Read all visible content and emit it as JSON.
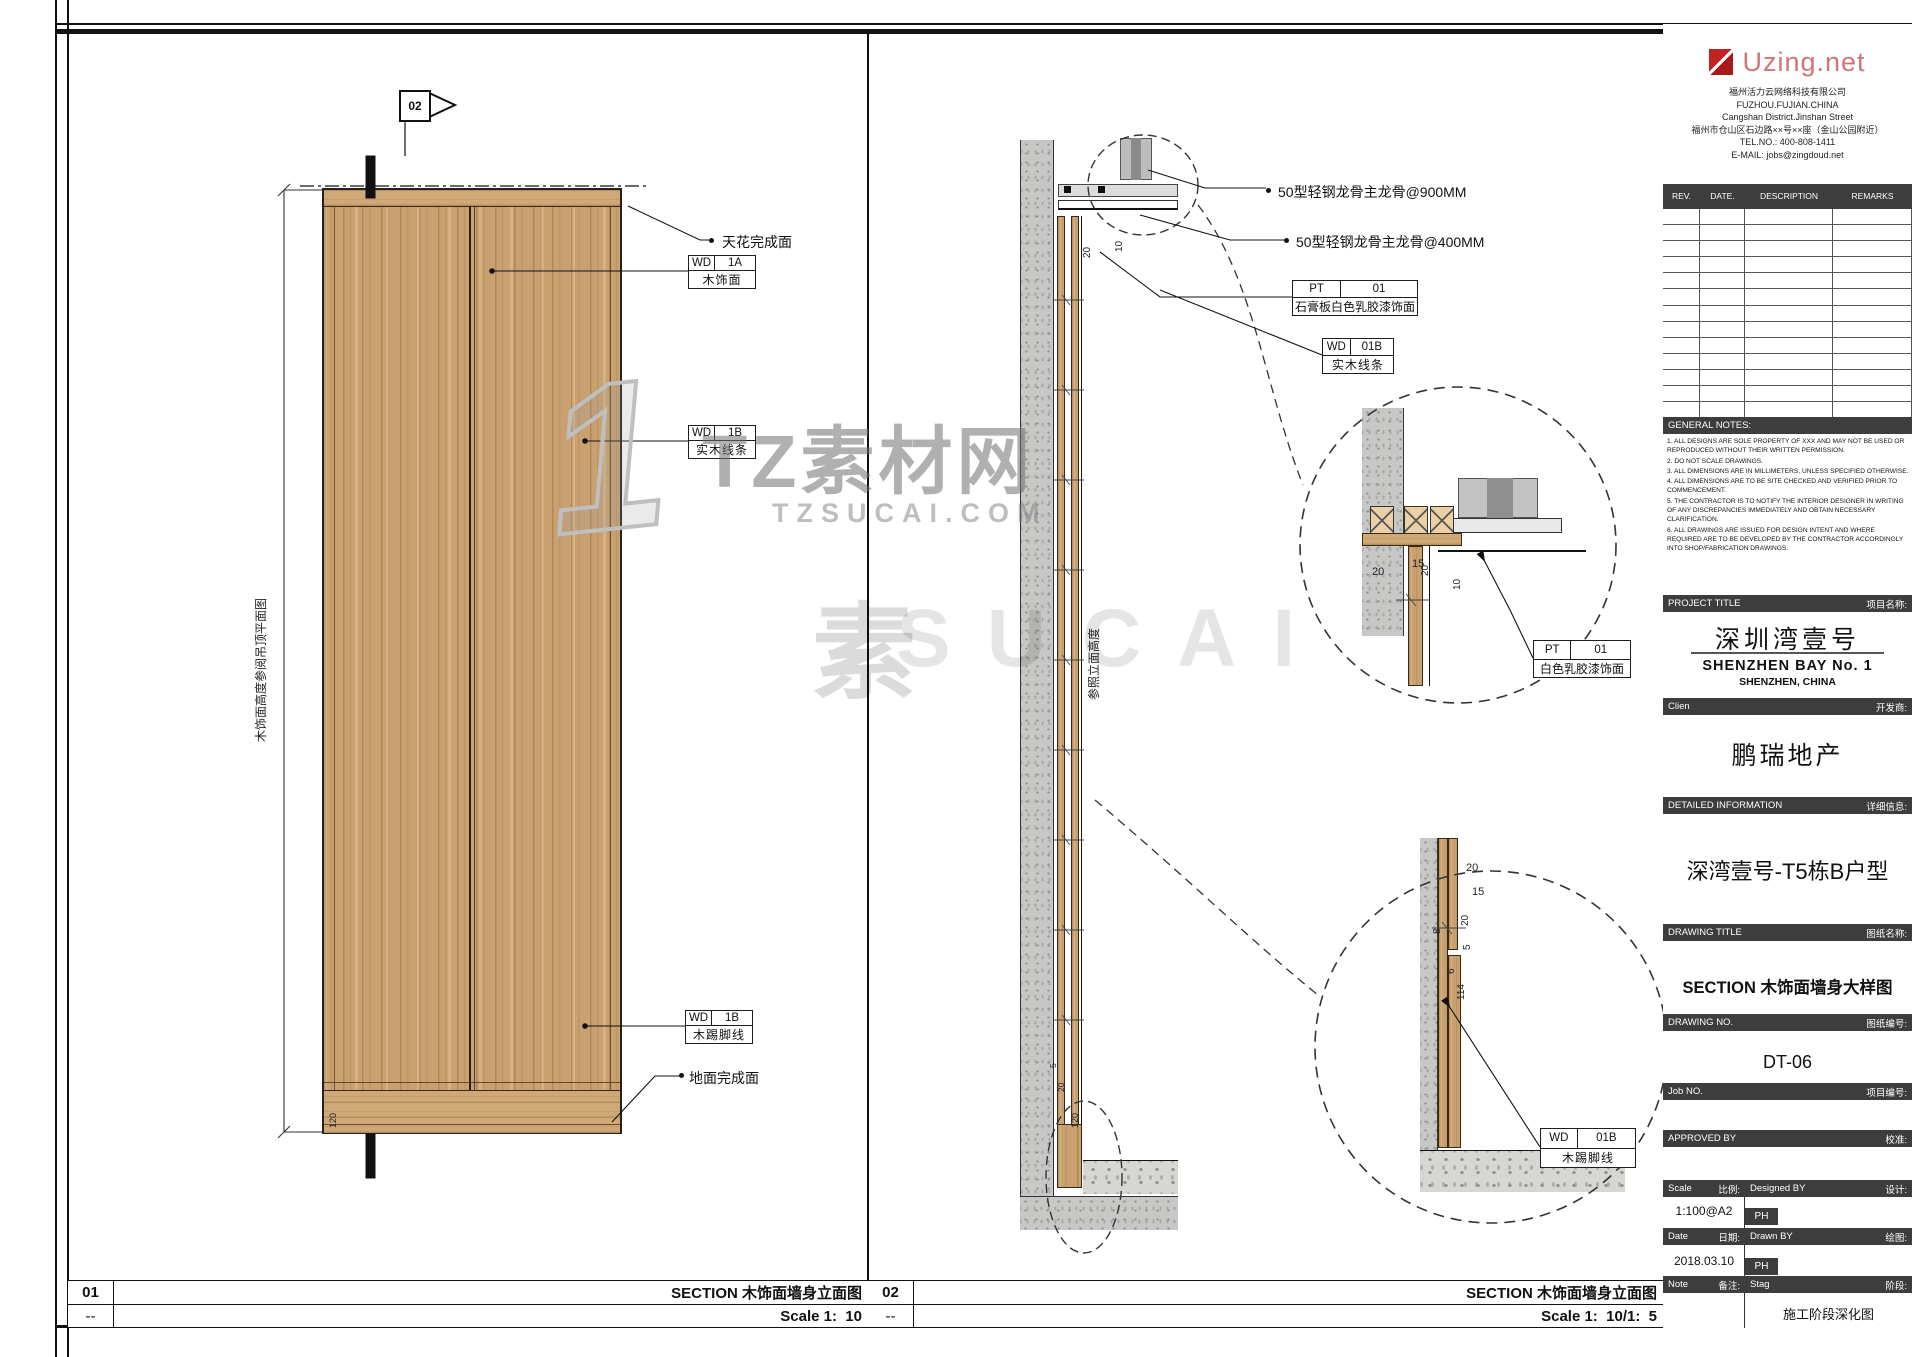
{
  "colors": {
    "accent_red": "#c32222",
    "logo_pink": "#d07575",
    "bar_dark": "#3d3d3d",
    "wood": "#c9a171",
    "concrete_gray": "#c7c7c5"
  },
  "watermark": {
    "big_one": "1",
    "brand": "TZ素材网",
    "domain": "TZSUCAI.COM",
    "faint_char": "素",
    "faint_letters": "SUCAI"
  },
  "panel1": {
    "number": "01",
    "rev": "--",
    "title": "SECTION 木饰面墙身立面图",
    "scale": "Scale 1:  10",
    "section_flag": "02",
    "height_note": "木饰面高度参阅吊顶平面图",
    "skirt_dim": "120",
    "labels": {
      "ceiling_finish": "天花完成面",
      "floor_finish": "地面完成面"
    },
    "tags": {
      "wd1a": {
        "code": "WD",
        "num": "1A",
        "desc": "木饰面"
      },
      "wd1b": {
        "code": "WD",
        "num": "1B",
        "desc": "实木线条"
      },
      "wd1b_skirt": {
        "code": "WD",
        "num": "1B",
        "desc": "木踢脚线"
      }
    }
  },
  "panel2": {
    "number": "02",
    "rev": "--",
    "title": "SECTION 木饰面墙身立面图",
    "scale": "Scale 1:  10/1:  5",
    "height_note": "参照立面高度",
    "labels": {
      "keel900": "50型轻钢龙骨主龙骨@900MM",
      "keel400": "50型轻钢龙骨主龙骨@400MM"
    },
    "tags": {
      "pt01_gypsum": {
        "code": "PT",
        "num": "01",
        "desc": "石膏板白色乳胶漆饰面"
      },
      "wd01b_trim": {
        "code": "WD",
        "num": "01B",
        "desc": "实木线条"
      },
      "pt01_paint": {
        "code": "PT",
        "num": "01",
        "desc": "白色乳胶漆饰面"
      },
      "wd01b_skirt": {
        "code": "WD",
        "num": "01B",
        "desc": "木踢脚线"
      }
    },
    "dims": {
      "top_a": "20",
      "top_b": "10",
      "dt_a": "20",
      "dt_b": "10",
      "dt_c": "15",
      "dt_d": "20",
      "db_a": "20",
      "db_b": "15",
      "db_c": "20",
      "db_d": "8",
      "db_e": "5",
      "db_f": "6",
      "db_g": "114",
      "fl_a": "120",
      "fl_b": "20",
      "fl_c": "5"
    }
  },
  "titleblock": {
    "logo_text": "Uzing.net",
    "company_lines": [
      "福州活力云网络科技有限公司",
      "FUZHOU.FUJIAN.CHINA",
      "Cangshan District.Jinshan Street",
      "福州市仓山区石边路××号××座（金山公园附近）",
      "TEL.NO.:  400-808-1411",
      "E-MAIL:  jobs@zingdoud.net"
    ],
    "rev_table": {
      "headers": [
        "REV.",
        "DATE.",
        "DESCRIPTION",
        "REMARKS"
      ],
      "empty_rows": 13
    },
    "general_notes": {
      "heading": "GENERAL NOTES:",
      "items": [
        "1. ALL DESIGNS ARE SOLE PROPERTY OF XXX AND MAY NOT BE  USED  OR  REPRODUCED  WITHOUT THEIR WRITTEN PERMISSION.",
        "2. DO NOT SCALE DRAWINGS.",
        "3. ALL DIMENSIONS ARE IN MILLIMETERS, UNLESS SPECIFIED OTHERWISE.",
        "4. ALL DIMENSIONS ARE TO BE SITE CHECKED AND VERIFIED PRIOR TO COMMENCEMENT.",
        "5. THE CONTRACTOR IS TO NOTIFY THE INTERIOR DESIGNER IN WRITING OF ANY DISCREPANCIES IMMEDIATELY AND OBTAIN NECESSARY CLARIFICATION.",
        "6. ALL DRAWINGS ARE ISSUED FOR DESIGN INTENT AND WHERE REQUIRED ARE TO BE DEVELOPED BY THE CONTRACTOR ACCORDINGLY INTO SHOP/FABRICATION DRAWINGS."
      ]
    },
    "project_title": {
      "label_en": "PROJECT TITLE",
      "label_cn": "项目名称:",
      "name_cn": "深圳湾壹号",
      "name_en": "SHENZHEN BAY No. 1",
      "location": "SHENZHEN, CHINA"
    },
    "client": {
      "label_en": "Clien",
      "label_cn": "开发商:",
      "name": "鹏瑞地产"
    },
    "detailed_info": {
      "label_en": "DETAILED INFORMATION",
      "label_cn": "详细信息:",
      "value": "深湾壹号-T5栋B户型"
    },
    "drawing_title": {
      "label_en": "DRAWING TITLE",
      "label_cn": "图纸名称:",
      "value": "SECTION 木饰面墙身大样图"
    },
    "drawing_no": {
      "label_en": "DRAWING NO.",
      "label_cn": "图纸编号:",
      "value": "DT-06"
    },
    "job_no": {
      "label_en": "Job NO.",
      "label_cn": "项目编号:"
    },
    "approved_by": {
      "label_en": "APPROVED BY",
      "label_cn": "校准:"
    },
    "scale": {
      "label_en": "Scale",
      "label_cn": "比例:",
      "value": "1:100@A2"
    },
    "designed_by": {
      "label_en": "Designed BY",
      "label_cn": "设计:",
      "value": "PH"
    },
    "date": {
      "label_en": "Date",
      "label_cn": "日期:",
      "value": "2018.03.10"
    },
    "drawn_by": {
      "label_en": "Drawn BY",
      "label_cn": "绘图:",
      "value": "PH"
    },
    "note": {
      "label_en": "Note",
      "label_cn": "备注:",
      "value": ""
    },
    "stage": {
      "label_en": "Stag",
      "label_cn": "阶段:",
      "value": "施工阶段深化图"
    }
  }
}
